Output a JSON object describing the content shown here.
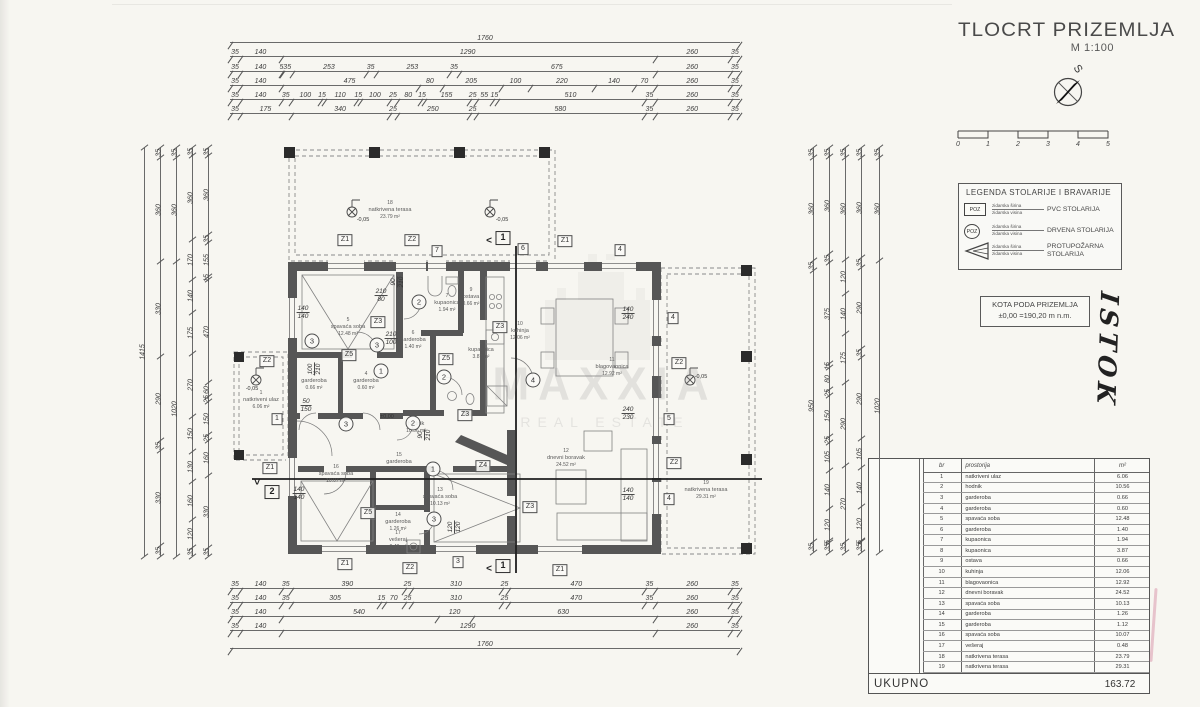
{
  "title_block": {
    "title": "TLOCRT PRIZEMLJA",
    "scale": "M 1:100",
    "compass_label": "S",
    "scalebar_ticks": [
      "0",
      "1",
      "2",
      "3",
      "4",
      "5"
    ]
  },
  "legend": {
    "title": "LEGENDA STOLARIJE I BRAVARIJE",
    "items": [
      {
        "tag": "POZ",
        "dim1": "zidarska širina",
        "dim2": "zidarska visina",
        "desc1": "PVC STOLARIJA",
        "desc2": ""
      },
      {
        "tag": "POZ",
        "dim1": "zidarska širina",
        "dim2": "zidarska visina",
        "desc1": "DRVENA STOLARIJA",
        "desc2": ""
      },
      {
        "tag": "",
        "dim1": "zidarska širina",
        "dim2": "zidarska visina",
        "desc1": "PROTUPOŽARNA",
        "desc2": "STOLARIJA"
      }
    ]
  },
  "kota": {
    "line1": "KOTA PODA PRIZEMLJA",
    "line2": "±0,00 =190,20 m n.m."
  },
  "handwriting": "ISTOK",
  "watermark": {
    "line1": "MAXXIA",
    "line2": "REAL ESTATE"
  },
  "rooms_table": {
    "headers": {
      "br": "br",
      "name": "prostorija",
      "unit": "m²"
    },
    "rows": [
      [
        "1",
        "natkriveni ulaz",
        "6.06"
      ],
      [
        "2",
        "hodnik",
        "10.56"
      ],
      [
        "3",
        "garderoba",
        "0.66"
      ],
      [
        "4",
        "garderoba",
        "0.60"
      ],
      [
        "5",
        "spavaća soba",
        "12.48"
      ],
      [
        "6",
        "garderoba",
        "1.40"
      ],
      [
        "7",
        "kupaonica",
        "1.94"
      ],
      [
        "8",
        "kupaonica",
        "3.87"
      ],
      [
        "9",
        "ostava",
        "0.66"
      ],
      [
        "10",
        "kuhinja",
        "12.06"
      ],
      [
        "11",
        "blagovaonica",
        "12.92"
      ],
      [
        "12",
        "dnevni boravak",
        "24.52"
      ],
      [
        "13",
        "spavaća soba",
        "10.13"
      ],
      [
        "14",
        "garderoba",
        "1.26"
      ],
      [
        "15",
        "garderoba",
        "1.12"
      ],
      [
        "16",
        "spavaća soba",
        "10.07"
      ],
      [
        "17",
        "vešeraj",
        "0.48"
      ],
      [
        "18",
        "natkrivena terasa",
        "23.79"
      ],
      [
        "19",
        "natkrivena terasa",
        "29.31"
      ]
    ],
    "total_label": "UKUPNO",
    "total": "163.72"
  },
  "dimensions": {
    "top": [
      [
        "1760"
      ],
      [
        "35",
        "140",
        "1290",
        "260",
        "35"
      ],
      [
        "35",
        "140",
        "5",
        "35",
        "253",
        "35",
        "253",
        "35",
        "675",
        "260",
        "35"
      ],
      [
        "35",
        "140",
        "475",
        "80",
        "205",
        "100",
        "220",
        "140",
        "70",
        "260",
        "35"
      ],
      [
        "35",
        "140",
        "35",
        "100",
        "15",
        "110",
        "15",
        "100",
        "25",
        "80",
        "15",
        "155",
        "25",
        "55",
        "15",
        "510",
        "35",
        "260",
        "35"
      ],
      [
        "35",
        "175",
        "340",
        "25",
        "250",
        "25",
        "580",
        "35",
        "260",
        "35"
      ]
    ],
    "bottom": [
      [
        "35",
        "140",
        "35",
        "390",
        "25",
        "310",
        "25",
        "470",
        "35",
        "260",
        "35"
      ],
      [
        "35",
        "140",
        "35",
        "305",
        "15",
        "70",
        "25",
        "310",
        "25",
        "470",
        "35",
        "260",
        "35"
      ],
      [
        "35",
        "140",
        "540",
        "120",
        "630",
        "260",
        "35"
      ],
      [
        "35",
        "140",
        "1290",
        "260",
        "35"
      ],
      [
        "1760"
      ]
    ],
    "left": [
      [
        "1415"
      ],
      [
        "35",
        "360",
        "330",
        "290",
        "35",
        "330",
        "35"
      ],
      [
        "35",
        "360",
        "1020"
      ],
      [
        "35",
        "360",
        "170",
        "140",
        "175",
        "270",
        "150",
        "130",
        "160",
        "120",
        "35"
      ],
      [
        "35",
        "360",
        "35",
        "155",
        "15",
        "470",
        "60",
        "25",
        "150",
        "25",
        "160",
        "330",
        "35"
      ]
    ],
    "right": [
      [
        "35",
        "360",
        "35",
        "950",
        "35"
      ],
      [
        "35",
        "360",
        "35",
        "375",
        "15",
        "80",
        "25",
        "150",
        "25",
        "105",
        "140",
        "120",
        "5",
        "35"
      ],
      [
        "35",
        "360",
        "120",
        "140",
        "175",
        "290",
        "270",
        "35"
      ],
      [
        "35",
        "360",
        "35",
        "290",
        "35",
        "290",
        "105",
        "140",
        "120",
        "5",
        "35"
      ],
      [
        "35",
        "360",
        "1020"
      ]
    ]
  },
  "plan": {
    "rooms": [
      {
        "num": "1",
        "name": "natkriveni ulaz",
        "area": "6.06 m²",
        "x": 261,
        "y": 400
      },
      {
        "num": "2",
        "name": "hodnik",
        "area": "10.56 m²",
        "x": 416,
        "y": 424
      },
      {
        "num": "3",
        "name": "garderoba",
        "area": "0.66 m²",
        "x": 314,
        "y": 381
      },
      {
        "num": "4",
        "name": "garderoba",
        "area": "0.60 m²",
        "x": 366,
        "y": 381
      },
      {
        "num": "5",
        "name": "spavaća soba",
        "area": "12.48 m²",
        "x": 348,
        "y": 327
      },
      {
        "num": "6",
        "name": "garderoba",
        "area": "1.40 m²",
        "x": 413,
        "y": 340
      },
      {
        "num": "7",
        "name": "kupaonica",
        "area": "1.94 m²",
        "x": 447,
        "y": 303
      },
      {
        "num": "8",
        "name": "kupaonica",
        "area": "3.87 m²",
        "x": 481,
        "y": 350
      },
      {
        "num": "9",
        "name": "ostava",
        "area": "0.66 m²",
        "x": 471,
        "y": 297
      },
      {
        "num": "10",
        "name": "kuhinja",
        "area": "12.06 m²",
        "x": 520,
        "y": 331
      },
      {
        "num": "11",
        "name": "blagovaonica",
        "area": "12.92 m²",
        "x": 612,
        "y": 367
      },
      {
        "num": "12",
        "name": "dnevni boravak",
        "area": "24.52 m²",
        "x": 566,
        "y": 458
      },
      {
        "num": "13",
        "name": "spavaća soba",
        "area": "10.13 m²",
        "x": 440,
        "y": 497
      },
      {
        "num": "14",
        "name": "garderoba",
        "area": "1.26 m²",
        "x": 398,
        "y": 522
      },
      {
        "num": "15",
        "name": "garderoba",
        "area": "1.12 m²",
        "x": 399,
        "y": 462
      },
      {
        "num": "16",
        "name": "spavaća soba",
        "area": "10.07 m²",
        "x": 336,
        "y": 474
      },
      {
        "num": "17",
        "name": "vešeraj",
        "area": "0.48 m²",
        "x": 398,
        "y": 540
      },
      {
        "num": "18",
        "name": "natkrivena terasa",
        "area": "23.79 m²",
        "x": 390,
        "y": 210
      },
      {
        "num": "19",
        "name": "natkrivena terasa",
        "area": "29.31 m²",
        "x": 706,
        "y": 490
      }
    ],
    "tags": [
      {
        "t": "Z1",
        "x": 345,
        "y": 240
      },
      {
        "t": "Z2",
        "x": 412,
        "y": 240
      },
      {
        "t": "7",
        "x": 437,
        "y": 251
      },
      {
        "t": "6",
        "x": 523,
        "y": 249
      },
      {
        "t": "Z1",
        "x": 565,
        "y": 241
      },
      {
        "t": "4",
        "x": 620,
        "y": 250
      },
      {
        "t": "Z2",
        "x": 267,
        "y": 361
      },
      {
        "t": "1",
        "x": 277,
        "y": 419
      },
      {
        "t": "Z1",
        "x": 270,
        "y": 468
      },
      {
        "t": "4",
        "x": 673,
        "y": 318
      },
      {
        "t": "Z2",
        "x": 679,
        "y": 363
      },
      {
        "t": "5",
        "x": 669,
        "y": 419
      },
      {
        "t": "Z2",
        "x": 674,
        "y": 463
      },
      {
        "t": "4",
        "x": 669,
        "y": 499
      },
      {
        "t": "Z1",
        "x": 345,
        "y": 564
      },
      {
        "t": "Z2",
        "x": 410,
        "y": 568
      },
      {
        "t": "3",
        "x": 458,
        "y": 562
      },
      {
        "t": "Z1",
        "x": 560,
        "y": 570
      },
      {
        "t": "Z3",
        "x": 378,
        "y": 322
      },
      {
        "t": "Z5",
        "x": 349,
        "y": 355
      },
      {
        "t": "Z5",
        "x": 446,
        "y": 359
      },
      {
        "t": "Z3",
        "x": 500,
        "y": 327
      },
      {
        "t": "Z3",
        "x": 465,
        "y": 415
      },
      {
        "t": "Z4",
        "x": 483,
        "y": 466
      },
      {
        "t": "Z3",
        "x": 530,
        "y": 507
      },
      {
        "t": "Z5",
        "x": 368,
        "y": 513
      }
    ],
    "circles": [
      {
        "t": "2",
        "x": 419,
        "y": 302
      },
      {
        "t": "3",
        "x": 312,
        "y": 341
      },
      {
        "t": "3",
        "x": 377,
        "y": 345
      },
      {
        "t": "1",
        "x": 381,
        "y": 371
      },
      {
        "t": "2",
        "x": 444,
        "y": 377
      },
      {
        "t": "3",
        "x": 346,
        "y": 424
      },
      {
        "t": "2",
        "x": 413,
        "y": 423
      },
      {
        "t": "1",
        "x": 433,
        "y": 469
      },
      {
        "t": "3",
        "x": 434,
        "y": 519
      },
      {
        "t": "4",
        "x": 533,
        "y": 380
      }
    ],
    "notes": [
      {
        "a": "210",
        "b": "80",
        "x": 381,
        "y": 296,
        "r": 0
      },
      {
        "a": "210",
        "b": "100",
        "x": 391,
        "y": 339,
        "r": 0
      },
      {
        "a": "140",
        "b": "140",
        "x": 303,
        "y": 313,
        "r": 0
      },
      {
        "a": "140",
        "b": "140",
        "x": 299,
        "y": 494,
        "r": 0
      },
      {
        "a": "140",
        "b": "240",
        "x": 628,
        "y": 314,
        "r": 0
      },
      {
        "a": "240",
        "b": "230",
        "x": 628,
        "y": 414,
        "r": 0
      },
      {
        "a": "140",
        "b": "140",
        "x": 628,
        "y": 495,
        "r": 0
      },
      {
        "a": "90",
        "b": "210",
        "x": 425,
        "y": 435,
        "r": 90
      },
      {
        "a": "90",
        "b": "210",
        "x": 398,
        "y": 282,
        "r": 90
      },
      {
        "a": "100",
        "b": "210",
        "x": 315,
        "y": 369,
        "r": 90
      },
      {
        "a": "120",
        "b": "120",
        "x": 455,
        "y": 527,
        "r": 90
      },
      {
        "a": "50",
        "b": "150",
        "x": 306,
        "y": 406,
        "r": 0
      }
    ],
    "levels": [
      {
        "t": "-0,05",
        "x": 252,
        "y": 389
      },
      {
        "t": "±0,00",
        "x": 387,
        "y": 417
      },
      {
        "t": "-0,05",
        "x": 701,
        "y": 377
      },
      {
        "t": "-0,05",
        "x": 363,
        "y": 220
      },
      {
        "t": "-0,05",
        "x": 502,
        "y": 220
      }
    ],
    "section_markers": [
      {
        "t": "1",
        "x": 503,
        "y": 238
      },
      {
        "t": "1",
        "x": 503,
        "y": 566
      },
      {
        "t": "2",
        "x": 272,
        "y": 492
      }
    ],
    "section_arrows": [
      {
        "t": "<",
        "x": 489,
        "y": 241,
        "r": 0
      },
      {
        "t": "<",
        "x": 489,
        "y": 569,
        "r": 0
      },
      {
        "t": "<",
        "x": 258,
        "y": 482,
        "r": -90
      }
    ]
  }
}
